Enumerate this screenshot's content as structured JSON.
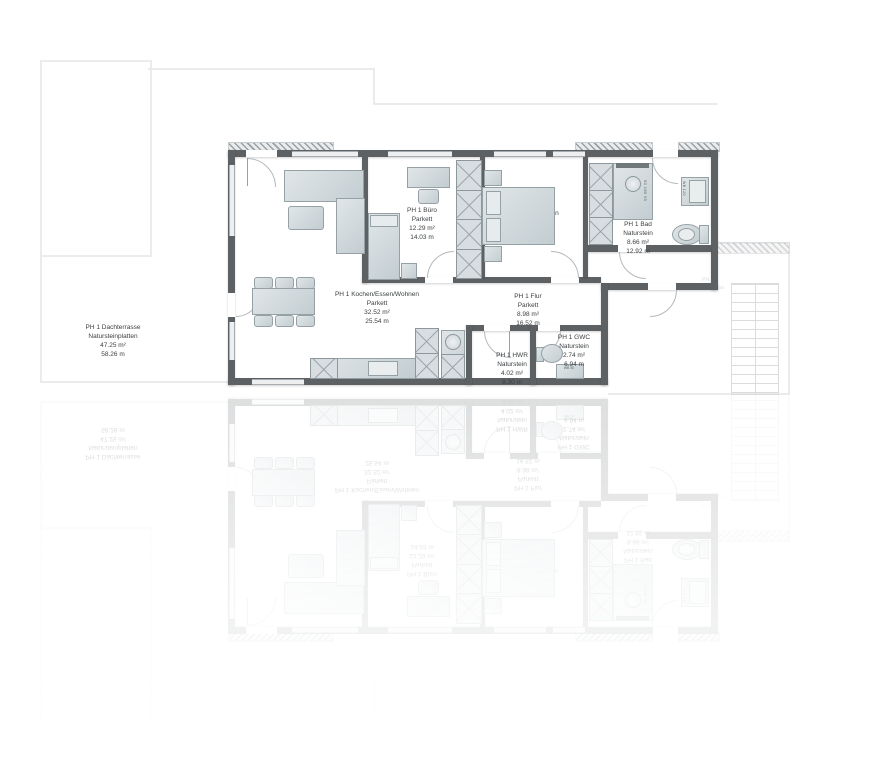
{
  "unit": "PH 1",
  "rooms": {
    "dachterrasse": {
      "name": "PH 1 Dachterrasse",
      "flooring": "Natursteinplatten",
      "area": "47.25 m²",
      "perimeter": "58.26 m"
    },
    "wohnen": {
      "name": "PH 1 Kochen/Essen/Wohnen",
      "flooring": "Parkett",
      "area": "32.52 m²",
      "perimeter": "25.54 m"
    },
    "buero": {
      "name": "PH 1 Büro",
      "flooring": "Parkett",
      "area": "12.29 m²",
      "perimeter": "14.03 m"
    },
    "schlafen": {
      "name": "PH 1 Schlafen"
    },
    "bad": {
      "name": "PH 1 Bad",
      "flooring": "Naturstein",
      "area": "8.66 m²",
      "perimeter": "12.92 m"
    },
    "flur": {
      "name": "PH 1 Flur",
      "flooring": "Parkett",
      "area": "8.98 m²",
      "perimeter": "16.52 m"
    },
    "hwr": {
      "name": "PH 1 HWR",
      "flooring": "Naturstein",
      "area": "4.02 m²",
      "perimeter": "8.30 m"
    },
    "gwc": {
      "name": "PH 1 GWC",
      "flooring": "Naturstein",
      "area": "2.74 m²",
      "perimeter": "6.94 m"
    }
  },
  "fixture_labels": {
    "shower_dims": "90 180 90",
    "bad_washbasin": "WB 120",
    "gwc_washbasin": "WB 50"
  },
  "stairwell": {
    "line1": "PH 1",
    "line2": "Treppenhaus"
  },
  "colors": {
    "wall": "#5d6164",
    "furniture": "#ccd4d8",
    "accent_dark": "#70787c"
  }
}
